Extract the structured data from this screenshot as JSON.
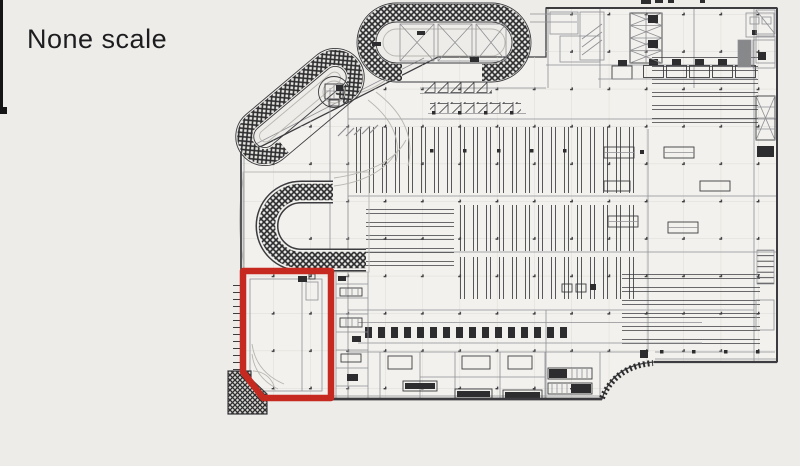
{
  "page": {
    "scale_label": "None scale"
  },
  "colors": {
    "paper": "#edece8",
    "plan_fill": "#f2f1ed",
    "ink": "#3c3c40",
    "ink_light": "#8f8f94",
    "guide": "#b7b6b0",
    "hatch_dark": "#2d2d2f",
    "hatch_bg": "#e4e3df",
    "gray_fill": "#87888a",
    "grid_line": "#dddcd6",
    "highlight_red": "#c5291f",
    "photo_edge": "#151515",
    "title_ink": "#1d1d1f"
  }
}
